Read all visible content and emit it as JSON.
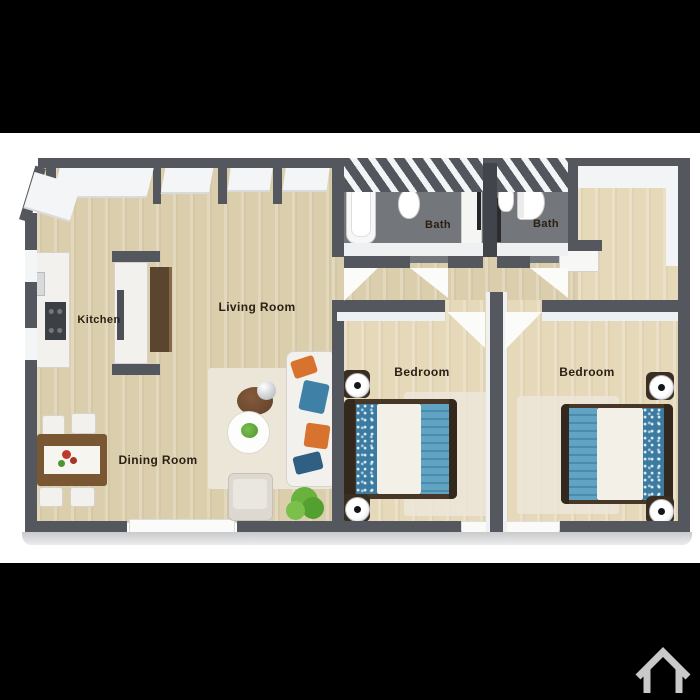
{
  "view": {
    "letterbox_color": "#000000",
    "background": "#ffffff"
  },
  "floor_plan": {
    "rooms": {
      "kitchen": {
        "label": "Kitchen"
      },
      "living": {
        "label": "Living Room"
      },
      "dining": {
        "label": "Dining Room"
      },
      "bath1": {
        "label": "Bath"
      },
      "bath2": {
        "label": "Bath"
      },
      "bedroom1": {
        "label": "Bedroom"
      },
      "bedroom2": {
        "label": "Bedroom"
      }
    },
    "colors": {
      "wall": "#54585e",
      "wood_floor": "#dbcead",
      "bedroom_floor": "#e6d9ba",
      "bath_floor": "#73767b",
      "accent_blue": "#4f93b5",
      "accent_orange": "#d8732f",
      "furniture_brown": "#795732",
      "plant_green": "#69b23e",
      "label_text": "#2b2014"
    }
  },
  "footer": {
    "icon": "house-outline-icon",
    "icon_color": "#c9c9c9"
  }
}
